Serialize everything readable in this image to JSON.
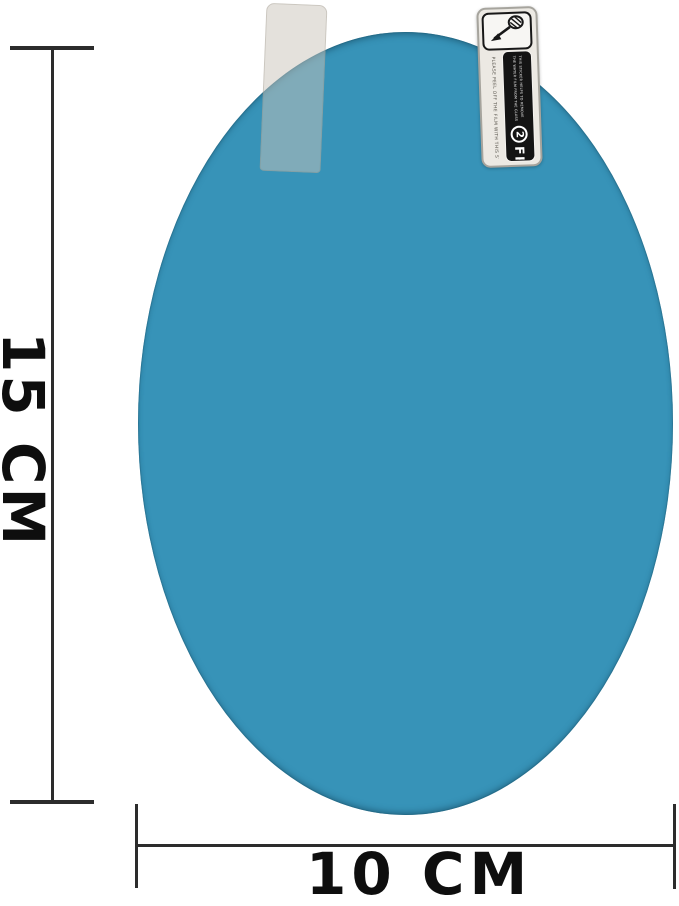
{
  "page": {
    "background": "#ffffff",
    "subject": "oval anti-fog rainproof film with dimension callouts"
  },
  "film": {
    "color": "#3793b8",
    "edge_shade": "#2a7699"
  },
  "peel_tab": {
    "appearance": "translucent-beige"
  },
  "label": {
    "step_number": "2",
    "title": "FRONT",
    "side_note": "PLEASE PEEL OFF THE FILM WITH THIS STICKER",
    "strip_note_line1": "THIS STICKER HELPS TO REMOVE",
    "strip_note_line2": "THE WATER FILM FROM THE GLASS",
    "colors": {
      "body": "#ece9e3",
      "strip": "#141414",
      "text": "#ffffff"
    }
  },
  "dimensions": {
    "height_label": "15 CM",
    "width_label": "10 CM",
    "line_color": "#2c2c2c",
    "text_color": "#0e0e0e"
  }
}
